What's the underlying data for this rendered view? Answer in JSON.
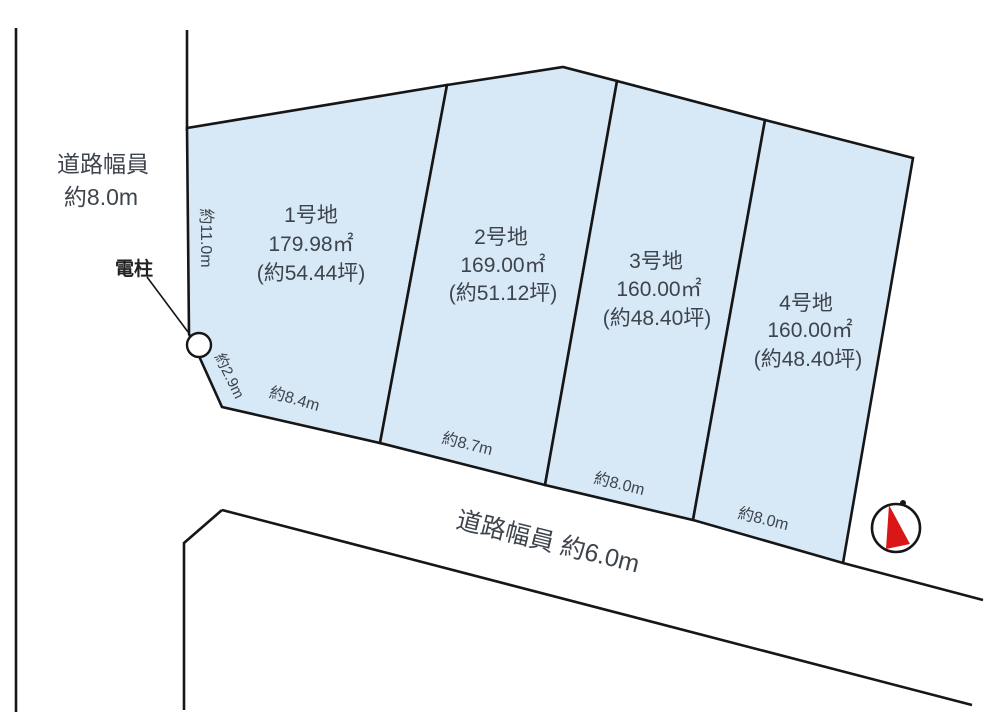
{
  "roads": {
    "left": {
      "label_line1": "道路幅員",
      "label_line2": "約8.0m"
    },
    "bottom": {
      "label": "道路幅員 約6.0m"
    }
  },
  "pole": {
    "label": "電柱"
  },
  "dimensions": {
    "left_depth": "約11.0m",
    "chamfer": "約2.9m",
    "plot1_frontage": "約8.4m",
    "plot2_frontage": "約8.7m",
    "plot3_frontage": "約8.0m",
    "plot4_frontage": "約8.0m"
  },
  "plots": [
    {
      "name": "1号地",
      "area_m2": "179.98㎡",
      "area_tsubo": "(約54.44坪)"
    },
    {
      "name": "2号地",
      "area_m2": "169.00㎡",
      "area_tsubo": "(約51.12坪)"
    },
    {
      "name": "3号地",
      "area_m2": "160.00㎡",
      "area_tsubo": "(約48.40坪)"
    },
    {
      "name": "4号地",
      "area_m2": "160.00㎡",
      "area_tsubo": "(約48.40坪)"
    }
  ],
  "colors": {
    "plot_fill": "#d7e8f7",
    "line": "#161616",
    "text": "#3e444c",
    "compass_red": "#d91717"
  }
}
